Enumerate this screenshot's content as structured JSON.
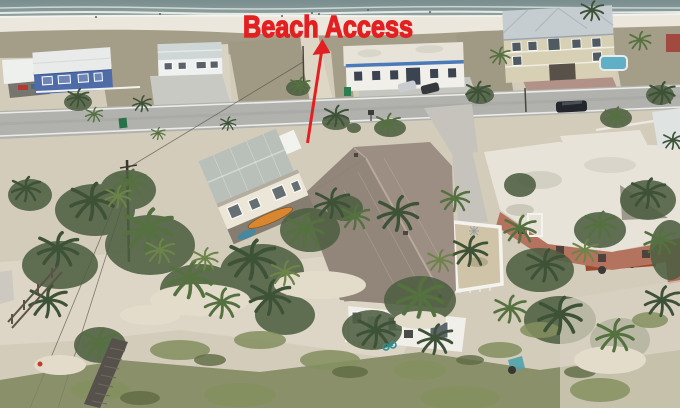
{
  "annotation": {
    "label": "Beach Access",
    "color": "#e32021"
  },
  "scene": {
    "kind": "aerial drone photograph",
    "setting": "beachfront residential street along a white-sand gulf shoreline",
    "landmarks": [
      "ocean with surf line",
      "white sand beach with beachgoers",
      "dune scrub strip",
      "sandy beach access path",
      "coastal road",
      "blue beach cottage with white roof and carport",
      "white beach house with gray hip roof",
      "white building with blue trim and two parked cars",
      "three-story tan beach house with pool and brick drive",
      "two-story cream house with metal roof and kayak stored below",
      "large brown shingle-roof beach house",
      "flat white-roof building with pink walls",
      "open white rooftop deck frame",
      "rusty trailer",
      "palm trees and shrubs",
      "sand dunes with beach grass",
      "wooden boardwalk",
      "wood dune fence",
      "utility pole with power lines",
      "teal bicycle by the house",
      "dark SUV on the road"
    ]
  },
  "colors": {
    "ocean_deep": "#798c8e",
    "ocean": "#95a7a4",
    "surf": "#eef1ee",
    "beach_sand": "#ece7dc",
    "dune_scrub": "#a49d88",
    "lot_sand": "#d3ccbb",
    "road": "#b1b2ae",
    "road_line": "#ebebe7",
    "shingle_roof": "#9c8e82",
    "metal_roof": "#b9c0ba",
    "cream_wall": "#ebe6d7",
    "white_wall": "#f1efe9",
    "blue_house": "#4e6ca8",
    "blue_trim": "#4a7ab8",
    "tan_wall": "#d8d0b5",
    "tan_roof": "#c5cdd1",
    "flat_roof": "#e7e3d9",
    "pink_wall": "#b4735f",
    "palm_dark": "#3d5237",
    "palm_mid": "#54713f",
    "palm_light": "#6c8449",
    "grass": "#84905f",
    "pool": "#5fb0c6",
    "kayak": "#d8862f",
    "rust": "#9c4a2f",
    "boardwalk": "#56514b"
  }
}
